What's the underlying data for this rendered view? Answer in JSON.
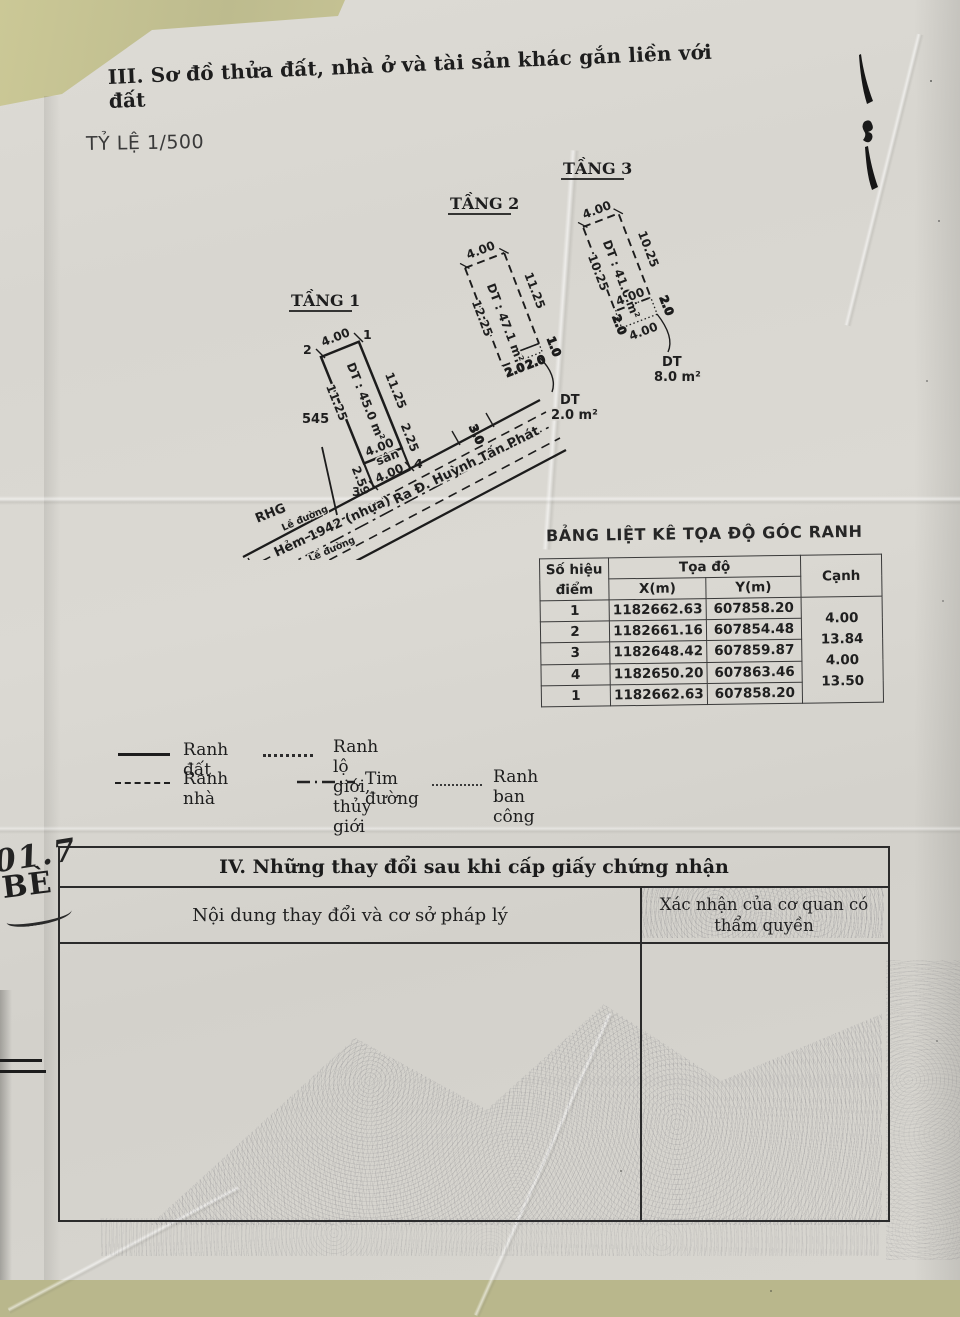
{
  "page": {
    "section3_title": "III. Sơ đồ thửa đất, nhà ở và tài sản khác gắn liền với đất",
    "scale_label": "TỶ LỆ 1/500"
  },
  "floors": {
    "f1": {
      "title": "TẦNG 1",
      "area": "DT : 45.0 m²",
      "dim_top": "4.00",
      "dim_left": "11.25",
      "dim_right": "11.25",
      "dim_inner": "4.00",
      "yard_label": "sân",
      "dim_yard_left": "2.59",
      "dim_yard_right": "2.25",
      "dim_bottom": "4.00",
      "corner1": "1",
      "corner2": "2",
      "corner3": "3",
      "corner4": "4",
      "neighbor_plot": "545"
    },
    "f2": {
      "title": "TẦNG 2",
      "area": "DT : 47.1 m²",
      "dim_top": "4.00",
      "dim_left": "12.25",
      "dim_right": "11.25",
      "dim_b1": "2.0",
      "dim_b2": "2.0",
      "dim_depth": "1.0",
      "balcony_dt": "DT",
      "balcony_area": "2.0 m²"
    },
    "f3": {
      "title": "TẦNG 3",
      "area": "DT : 41.0 m²",
      "dim_top": "4.00",
      "dim_left": "10.25",
      "dim_right": "10.25",
      "dim_mid": "4.00",
      "dim_bal_left": "2.0",
      "dim_bal_right": "2.0",
      "dim_bal_bottom": "4.00",
      "balcony_dt": "DT",
      "balcony_area": "8.0 m²"
    }
  },
  "road": {
    "rhg": "RHG",
    "sidewalk_top": "Lề đường",
    "name": "Hẻm 1942 (nhựa)",
    "direction": "Ra Đ. Huỳnh Tấn Phát",
    "sidewalk_bottom": "Lề đường",
    "width": "6.00",
    "frontage": "3.0"
  },
  "coord_table": {
    "title": "BẢNG LIỆT KÊ TỌA ĐỘ GÓC RANH",
    "col_point": "Số hiệu điểm",
    "col_coord": "Tọa độ",
    "col_x": "X(m)",
    "col_y": "Y(m)",
    "col_edge": "Cạnh",
    "rows": [
      {
        "p": "1",
        "x": "1182662.63",
        "y": "607858.20"
      },
      {
        "p": "2",
        "x": "1182661.16",
        "y": "607854.48"
      },
      {
        "p": "3",
        "x": "1182648.42",
        "y": "607859.87"
      },
      {
        "p": "4",
        "x": "1182650.20",
        "y": "607863.46"
      },
      {
        "p": "1",
        "x": "1182662.63",
        "y": "607858.20"
      }
    ],
    "edges": [
      "4.00",
      "13.84",
      "4.00",
      "13.50"
    ]
  },
  "legend": {
    "items": [
      {
        "label": "Ranh đất"
      },
      {
        "label": "Ranh lộ giới, thủy giới"
      },
      {
        "label": "Ranh nhà"
      },
      {
        "label": "Tim đường"
      },
      {
        "label": "Ranh ban công"
      }
    ]
  },
  "section4": {
    "title": "IV. Những thay đổi sau khi cấp giấy chứng nhận",
    "col_content": "Nội dung thay đổi và cơ sở pháp lý",
    "col_confirm": "Xác nhận của cơ quan có thẩm quyền"
  },
  "annotations": {
    "hw_line1": "01.7",
    "hw_line2": "BÈ"
  }
}
